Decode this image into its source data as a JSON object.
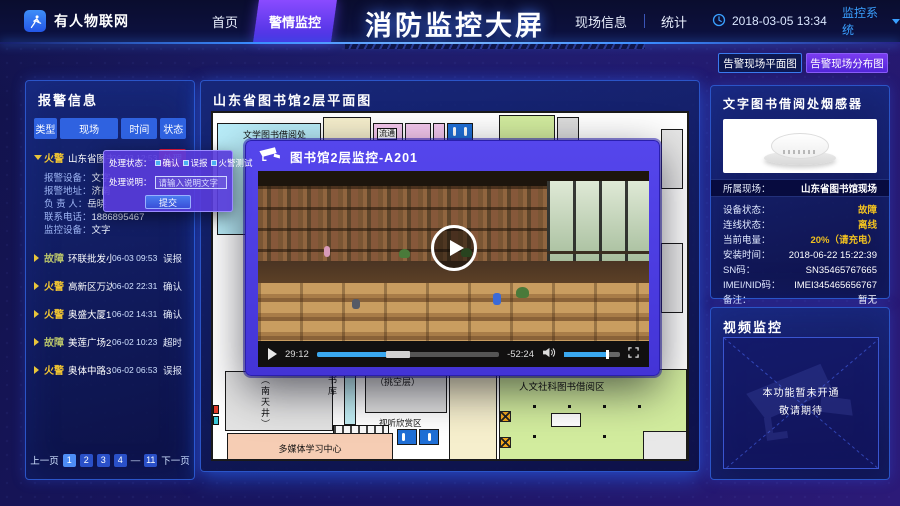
{
  "colors": {
    "accent_blue": "#3a8cff",
    "active_purple": "#6a3cf0",
    "alert_red": "#e8173d",
    "warn_yellow": "#f0c020",
    "fire_type": "#f5c832",
    "fault_type": "#b9c46a",
    "panel_border": "#2b55c8"
  },
  "topbar": {
    "logo_text": "有人物联网",
    "nav": [
      {
        "label": "首页"
      },
      {
        "label": "警情监控"
      }
    ],
    "title": "消防监控大屏",
    "nav_right": [
      {
        "label": "现场信息"
      },
      {
        "label": "统计"
      }
    ],
    "datetime": "2018-03-05 13:34",
    "system_menu": "监控系统"
  },
  "alarm": {
    "panel_title": "报警信息",
    "columns": [
      "类型",
      "现场",
      "时间",
      "状态"
    ],
    "rows": [
      {
        "type": "火警",
        "site": "山东省图书馆2层",
        "time": "06-03 12:53",
        "status": "处理"
      },
      {
        "type": "故障",
        "site": "环联批发小商场",
        "time": "06-03 09:53",
        "status": "误报"
      },
      {
        "type": "火警",
        "site": "高新区万达广场",
        "time": "06-02 22:31",
        "status": "确认"
      },
      {
        "type": "火警",
        "site": "奥盛大厦1号楼",
        "time": "06-02 14:31",
        "status": "确认"
      },
      {
        "type": "故障",
        "site": "美莲广场2层",
        "time": "06-02 10:23",
        "status": "超时"
      },
      {
        "type": "火警",
        "site": "奥体中路314号",
        "time": "06-02 06:53",
        "status": "误报"
      }
    ],
    "detail": [
      {
        "label": "报警设备：",
        "value": "文字"
      },
      {
        "label": "报警地址：",
        "value": "济南"
      },
      {
        "label": "负 责 人：",
        "value": "岳晓"
      },
      {
        "label": "联系电话：",
        "value": "1886895467"
      },
      {
        "label": "监控设备：",
        "value": "文字"
      }
    ],
    "pagination": {
      "prev": "上一页",
      "pages": [
        "1",
        "2",
        "3",
        "4"
      ],
      "gap": "—",
      "last_page": "11",
      "next": "下一页",
      "current_page": "1"
    }
  },
  "popup": {
    "status_label": "处理状态：",
    "options": [
      {
        "label": "确认"
      },
      {
        "label": "误报"
      },
      {
        "label": "火警测试"
      }
    ],
    "desc_label": "处理说明：",
    "input_placeholder": "请输入说明文字",
    "submit_label": "提交"
  },
  "map": {
    "title": "山东省图书馆2层平面图",
    "labels": {
      "wenxue": "文学图书借阅处",
      "liutong": "流通",
      "renwen": "人文社科图书借阅区",
      "shiting": "视听欣赏区",
      "duomeiti": "多媒体学习中心",
      "nantianjing": "（南天井）",
      "shuku": "书库",
      "tiaokong": "（挑空层）"
    }
  },
  "video_modal": {
    "title": "图书馆2层监控-A201",
    "current_time": "29:12",
    "remaining_time": "-52:24"
  },
  "right_panel": {
    "buttons": [
      {
        "label": "告警现场平面图"
      },
      {
        "label": "告警现场分布图"
      }
    ],
    "sensor": {
      "title": "文字图书借阅处烟感器",
      "site_label": "所属现场：",
      "site_value": "山东省图书馆现场",
      "details": [
        {
          "label": "设备状态：",
          "value": "故障"
        },
        {
          "label": "连线状态：",
          "value": "离线"
        },
        {
          "label": "当前电量：",
          "value": "20%（请充电）"
        },
        {
          "label": "安装时间：",
          "value": "2018-06-22 15:22:39"
        },
        {
          "label": "SN码：",
          "value": "SN35465767665"
        },
        {
          "label": "IMEI/NID码：",
          "value": "IMEI345465656767"
        },
        {
          "label": "备注：",
          "value": "暂无"
        }
      ]
    },
    "video": {
      "title": "视频监控",
      "placeholder_line1": "本功能暂未开通",
      "placeholder_line2": "敬请期待"
    }
  }
}
